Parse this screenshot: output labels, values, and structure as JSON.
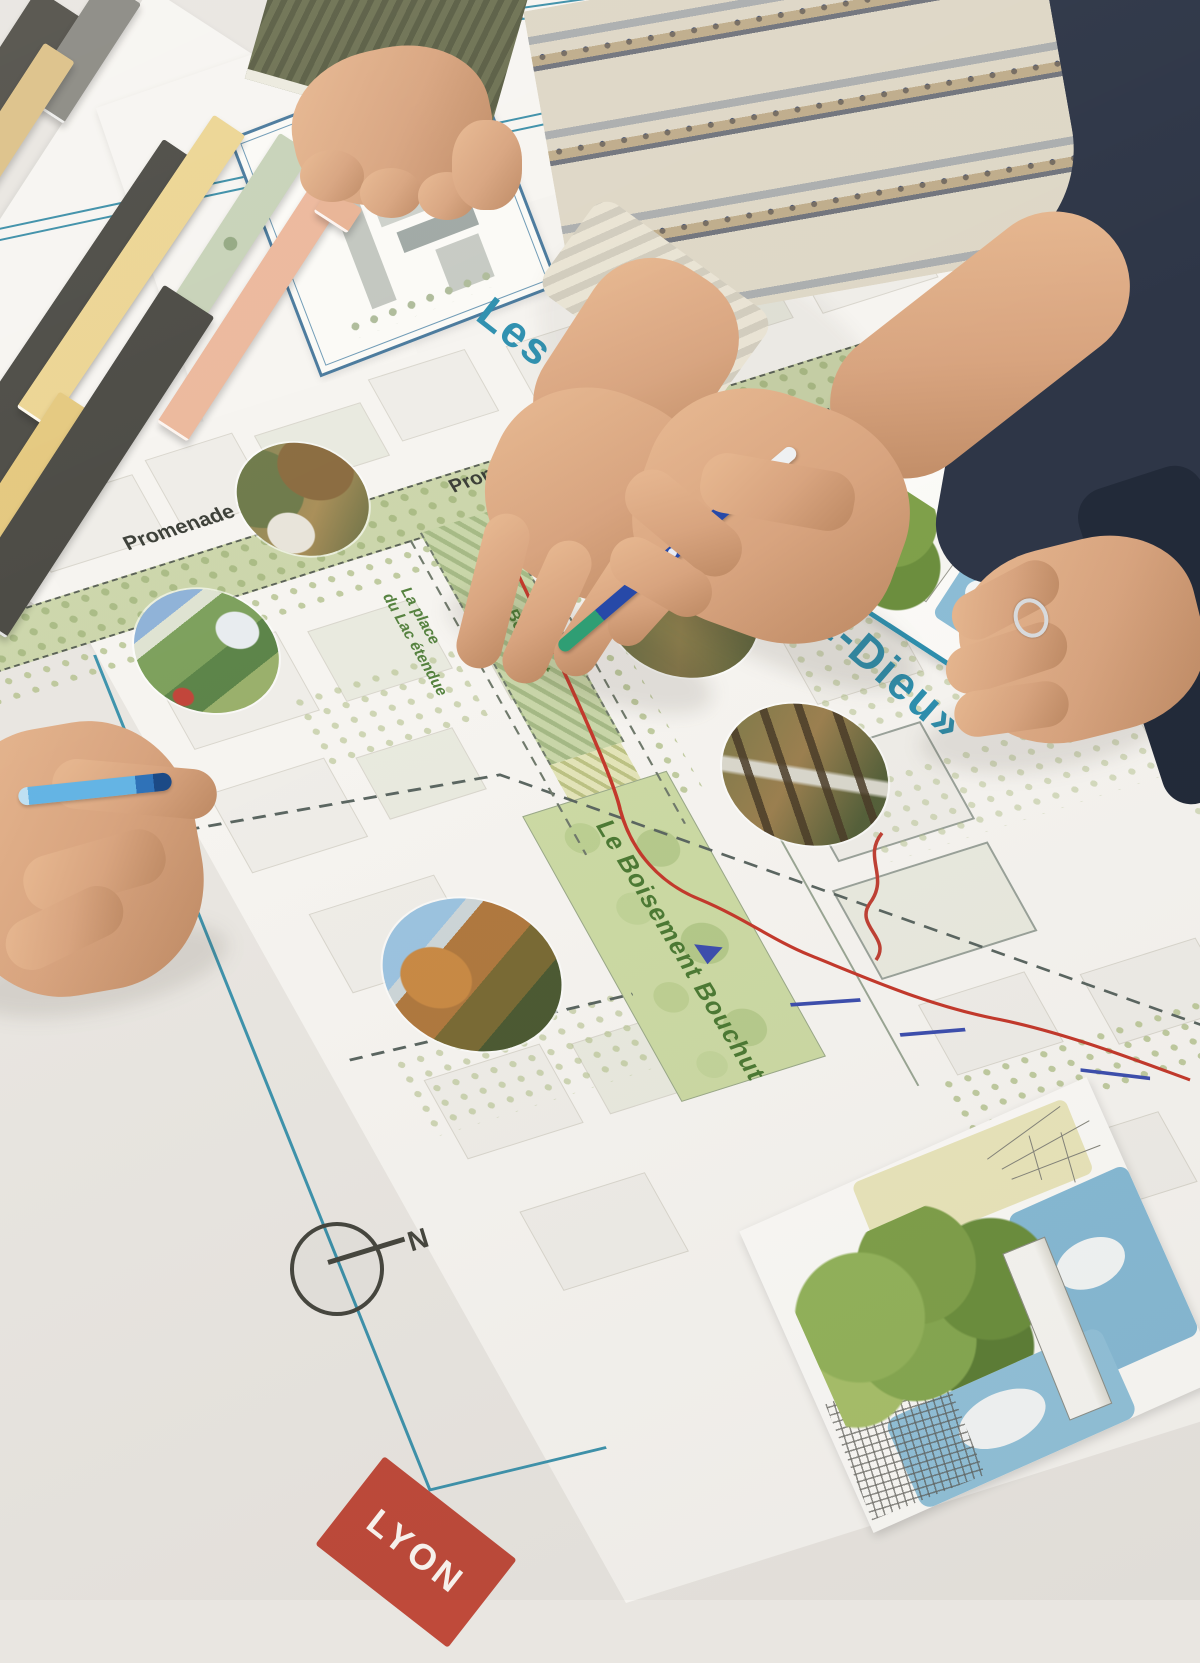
{
  "poster": {
    "title_start": "Les",
    "title_end": "art-Dieu»",
    "labels": {
      "promenade_a": "Promenade Gardibaldi",
      "promenade_b": "Promenade Gardibaldi",
      "place_line1": "La place",
      "place_line2": "du Lac étendue",
      "allee": "L'allée Bouchut",
      "lac_right": "du Lac étendue",
      "boisement": "Le Boisement Bouchut",
      "compass_north": "N"
    },
    "lyon_logo": "LYON"
  },
  "inset_card": {
    "title": "la Part-Dieu"
  },
  "colors": {
    "poster_teal": "#2d8fae",
    "map_green": "#ccdaa4",
    "band_green": "#ccd6ab",
    "route_red": "#c4392c",
    "route_blue": "#3d4fae",
    "lyon_red": "#bf4a3a",
    "pen_blue": "#2749a8",
    "pen_grip_green": "#2f9e74",
    "marker_blue": "#64b4e4"
  }
}
